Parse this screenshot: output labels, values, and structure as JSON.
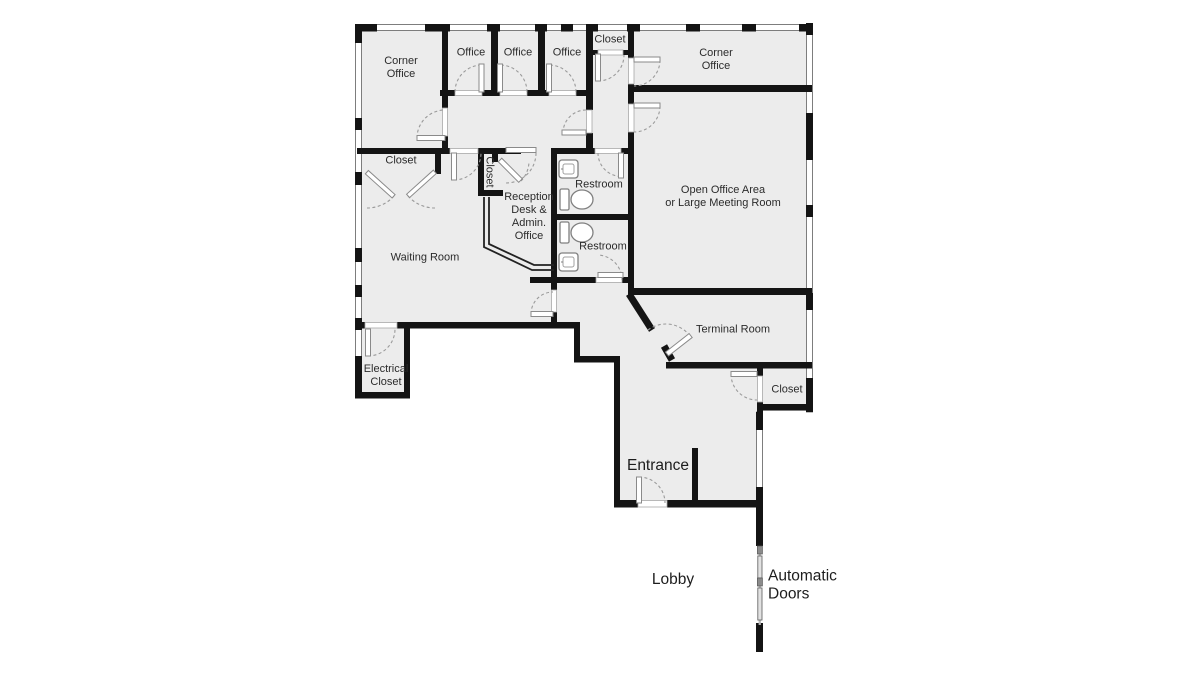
{
  "floorplan": {
    "title": "Office Floor Plan",
    "rooms": {
      "corner_office_tl": "Corner\nOffice",
      "office_1": "Office",
      "office_2": "Office",
      "office_3": "Office",
      "closet_top": "Closet",
      "corner_office_tr": "Corner\nOffice",
      "closet_left": "Closet",
      "closet_mid": "Closet",
      "restroom_1": "Restroom",
      "reception": "Reception\nDesk &\nAdmin.\nOffice",
      "restroom_2": "Restroom",
      "open_office": "Open Office Area\nor Large Meeting Room",
      "waiting_room": "Waiting Room",
      "terminal_room": "Terminal Room",
      "electrical_closet": "Electrical\nCloset",
      "closet_right": "Closet",
      "entrance": "Entrance",
      "lobby": "Lobby",
      "automatic_doors": "Automatic\nDoors"
    },
    "colors": {
      "wall": "#141414",
      "room_fill": "#ececec",
      "door_arc": "#9a9a9a",
      "window_edge": "#7d7d7d",
      "text": "#2b2b2b"
    }
  }
}
